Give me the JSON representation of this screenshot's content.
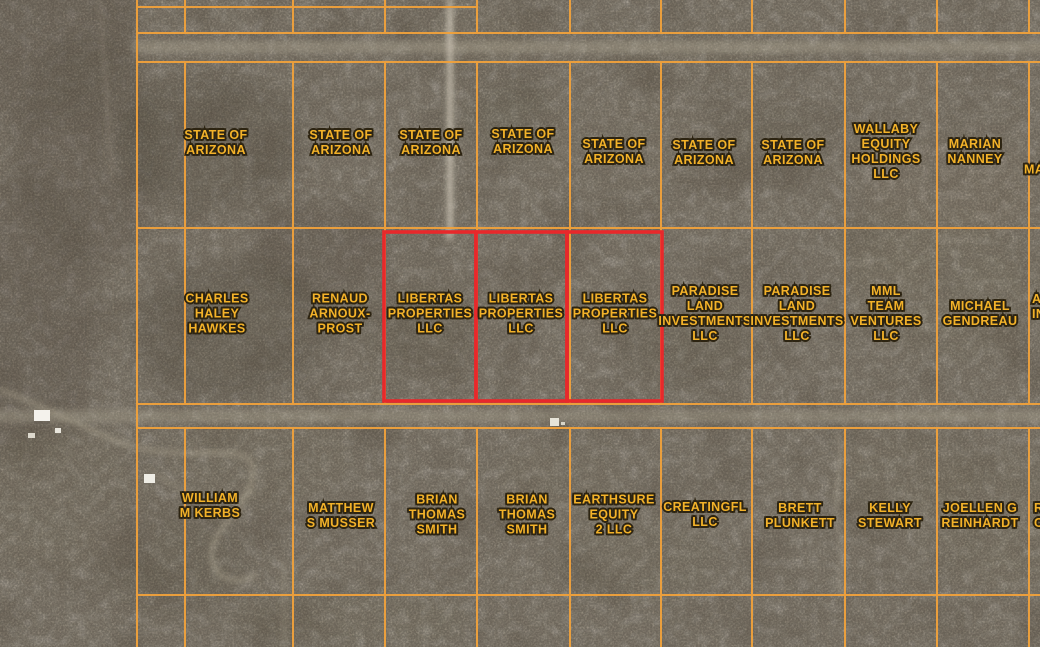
{
  "map": {
    "type": "satellite-parcel-viewer",
    "colors": {
      "terrain_base": "#8c8274",
      "parcel_line": "#f1a23b",
      "selected_parcel_outline": "#e8282b",
      "label_text": "#f3b229",
      "label_outline": "#2d2412",
      "road": "#c9c1b1"
    },
    "selected_owner": "LIBERTAS PROPERTIES LLC",
    "selected_parcel_count": 3
  },
  "parcels": [
    {
      "label": "STATE OF\nARIZONA",
      "x": 216,
      "y": 143
    },
    {
      "label": "STATE OF\nARIZONA",
      "x": 341,
      "y": 143
    },
    {
      "label": "STATE OF\nARIZONA",
      "x": 431,
      "y": 143
    },
    {
      "label": "STATE OF\nARIZONA",
      "x": 523,
      "y": 142
    },
    {
      "label": "STATE OF\nARIZONA",
      "x": 614,
      "y": 152
    },
    {
      "label": "STATE OF\nARIZONA",
      "x": 704,
      "y": 153
    },
    {
      "label": "STATE OF\nARIZONA",
      "x": 793,
      "y": 153
    },
    {
      "label": "WALLABY\nEQUITY\nHOLDINGS\nLLC",
      "x": 886,
      "y": 152
    },
    {
      "label": "MARIAN\nNANNEY",
      "x": 975,
      "y": 152
    },
    {
      "label": "MA",
      "x": 1024,
      "y": 170,
      "align": "left"
    },
    {
      "label": "CHARLES\nHALEY\nHAWKES",
      "x": 217,
      "y": 314
    },
    {
      "label": "RENAUD\nARNOUX-\nPROST",
      "x": 340,
      "y": 314
    },
    {
      "label": "LIBERTAS\nPROPERTIES\nLLC",
      "x": 430,
      "y": 314,
      "highlighted": true
    },
    {
      "label": "LIBERTAS\nPROPERTIES\nLLC",
      "x": 521,
      "y": 314,
      "highlighted": true
    },
    {
      "label": "LIBERTAS\nPROPERTIES\nLLC",
      "x": 615,
      "y": 314,
      "highlighted": true
    },
    {
      "label": "PARADISE\nLAND\nINVESTMENTS\nLLC",
      "x": 705,
      "y": 314
    },
    {
      "label": "PARADISE\nLAND\nINVESTMENTS\nLLC",
      "x": 797,
      "y": 314
    },
    {
      "label": "MML\nTEAM\nVENTURES\nLLC",
      "x": 886,
      "y": 314
    },
    {
      "label": "MICHAEL\nGENDREAU",
      "x": 980,
      "y": 314
    },
    {
      "label": "A\nIN",
      "x": 1032,
      "y": 307,
      "align": "left"
    },
    {
      "label": "WILLIAM\nM KERBS",
      "x": 210,
      "y": 506
    },
    {
      "label": "MATTHEW\nS MUSSER",
      "x": 341,
      "y": 516
    },
    {
      "label": "BRIAN\nTHOMAS\nSMITH",
      "x": 437,
      "y": 515
    },
    {
      "label": "BRIAN\nTHOMAS\nSMITH",
      "x": 527,
      "y": 515
    },
    {
      "label": "EARTHSURE\nEQUITY\n2 LLC",
      "x": 614,
      "y": 515
    },
    {
      "label": "CREATINGFL\nLLC",
      "x": 705,
      "y": 515
    },
    {
      "label": "BRETT\nPLUNKETT",
      "x": 800,
      "y": 516
    },
    {
      "label": "KELLY\nSTEWART",
      "x": 890,
      "y": 516
    },
    {
      "label": "JOELLEN G\nREINHARDT",
      "x": 980,
      "y": 516
    },
    {
      "label": "R\nC",
      "x": 1034,
      "y": 516,
      "align": "left"
    }
  ]
}
